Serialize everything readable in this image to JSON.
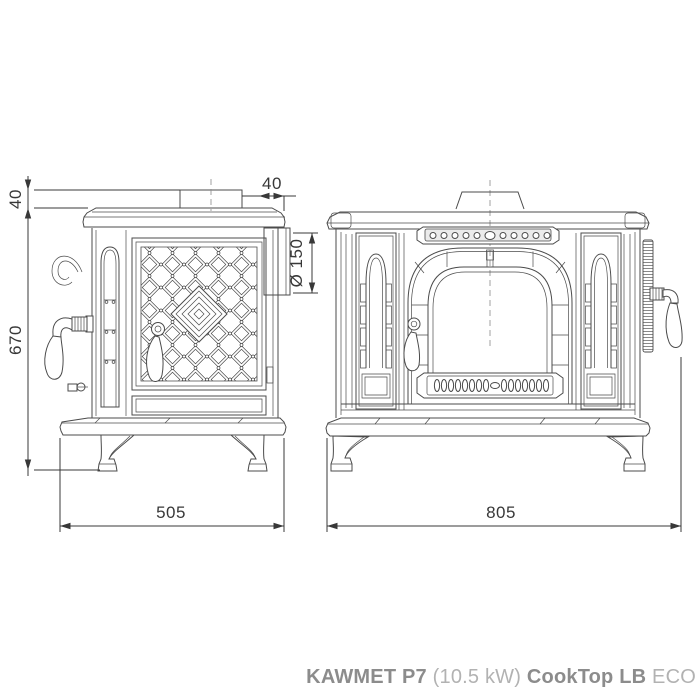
{
  "caption": {
    "brand": "KAWMET P7",
    "power": "(10.5 kW)",
    "model": "CookTop LB",
    "variant": "ECO"
  },
  "dimensions": {
    "flue_height": "40",
    "flue_setback": "40",
    "flue_diameter": "Ø 150",
    "height": "670",
    "depth": "505",
    "width": "805"
  },
  "colors": {
    "line": "#4b4b4b",
    "dim": "#383838",
    "fill_light": "#ebebeb",
    "caption_strong": "#8c8c8c",
    "caption_light": "#b2b2b2"
  }
}
